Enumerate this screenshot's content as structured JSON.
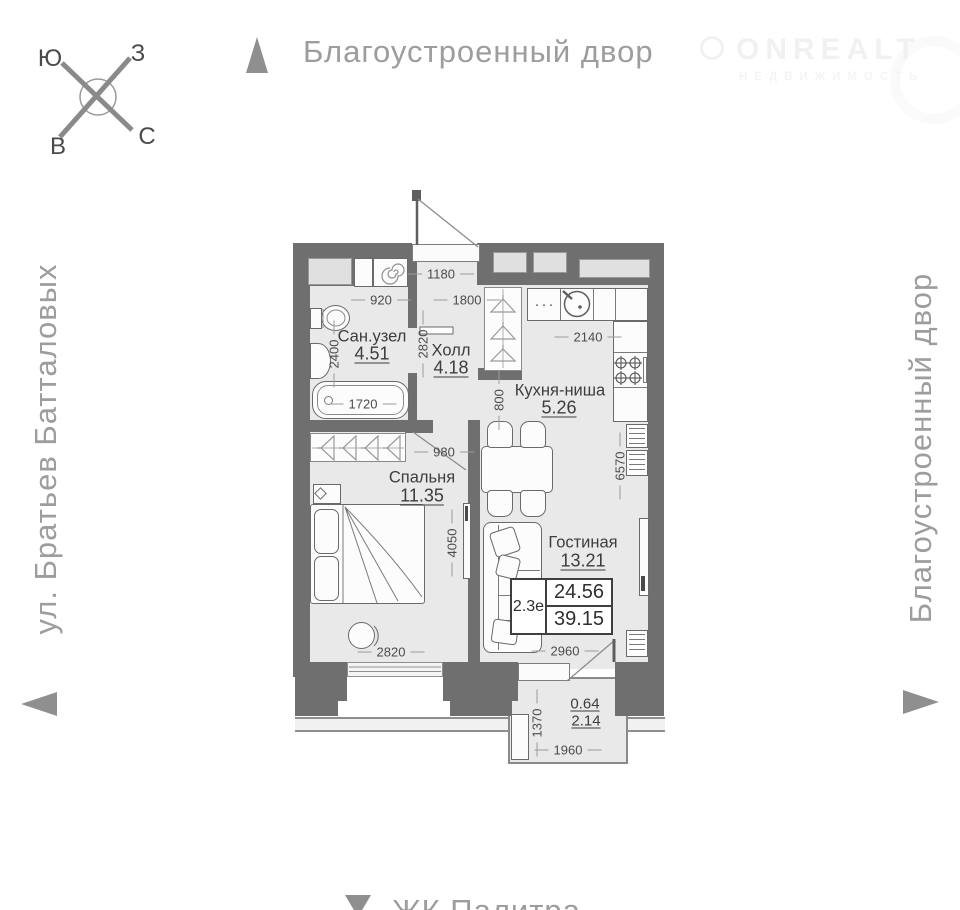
{
  "compass": {
    "top_left": "Ю",
    "top_right": "З",
    "bottom_left": "В",
    "bottom_right": "С"
  },
  "surroundings": {
    "top": "Благоустроенный двор",
    "right": "Благоустроенный двор",
    "left": "ул. Братьев Батталовых",
    "bottom": "ЖК Палитра"
  },
  "logo": {
    "title": "ONREALT",
    "subtitle": "НЕДВИЖИМОСТЬ"
  },
  "plan": {
    "rooms": [
      {
        "name": "Сан.узел",
        "area": "4.51"
      },
      {
        "name": "Холл",
        "area": "4.18"
      },
      {
        "name": "Кухня-ниша",
        "area": "5.26"
      },
      {
        "name": "Спальня",
        "area": "11.35"
      },
      {
        "name": "Гостиная",
        "area": "13.21"
      }
    ],
    "balcony": {
      "reduced_area": "0.64",
      "area": "2.14"
    },
    "summary": {
      "unit_type": "2.3е",
      "living_area": "24.56",
      "total_area": "39.15"
    },
    "dims": {
      "entry_width": "1180",
      "bath_width": "920",
      "hall_width": "1800",
      "hall_depth": "2820",
      "bath_depth": "2400",
      "tub_length": "1720",
      "kitchen_width": "2140",
      "kitchen_depth": "800",
      "bed_door": "980",
      "right_side": "6570",
      "bedroom_depth": "4050",
      "bedroom_width": "2820",
      "living_width": "2960",
      "balcony_depth": "1370",
      "balcony_width": "1960"
    },
    "kitchen_dots": "···"
  },
  "colors": {
    "wall": "#6f6f6f",
    "floor": "#e9e9e9",
    "muted": "#9c9c9c",
    "text": "#3d3d3d"
  }
}
